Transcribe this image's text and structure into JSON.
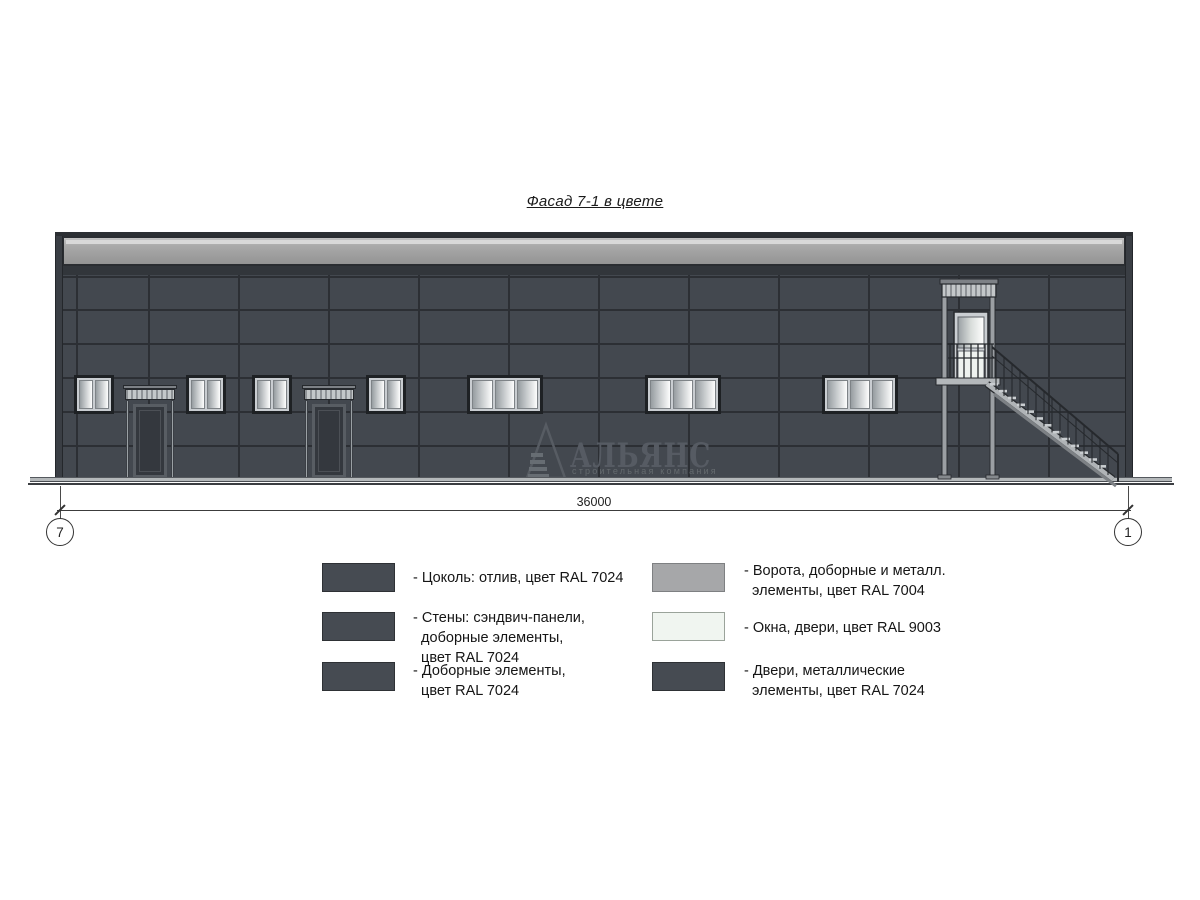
{
  "title": "Фасад 7-1 в цвете",
  "watermark": {
    "name": "АЛЬЯНС",
    "subtitle": "строительная компания"
  },
  "dimension": {
    "value": "36000",
    "axis_left": "7",
    "axis_right": "1"
  },
  "legend": {
    "left": [
      {
        "color": "#464b52",
        "border": "#2e3135",
        "lines": [
          "- Цоколь: отлив, цвет RAL 7024"
        ]
      },
      {
        "color": "#464b52",
        "border": "#2e3135",
        "lines": [
          "- Стены: сэндвич-панели,",
          "  доборные элементы,",
          "  цвет RAL 7024"
        ]
      },
      {
        "color": "#464b52",
        "border": "#2e3135",
        "lines": [
          "- Доборные элементы,",
          "  цвет RAL 7024"
        ]
      }
    ],
    "right": [
      {
        "color": "#a6a7a9",
        "border": "#7e8082",
        "lines": [
          "- Ворота, доборные и металл.",
          "  элементы, цвет RAL 7004"
        ]
      },
      {
        "color": "#f0f5f0",
        "border": "#9aa39a",
        "lines": [
          "- Окна, двери, цвет RAL 9003"
        ]
      },
      {
        "color": "#464b52",
        "border": "#2e3135",
        "lines": [
          "- Двери, металлические",
          "  элементы, цвет RAL 7024"
        ]
      }
    ]
  },
  "colors": {
    "wall": "#43484f",
    "joint": "#2c2f34",
    "parapet": "#a9a9a9",
    "window_pane": "#f3f6f3",
    "metal_light": "#b4b8ba"
  }
}
